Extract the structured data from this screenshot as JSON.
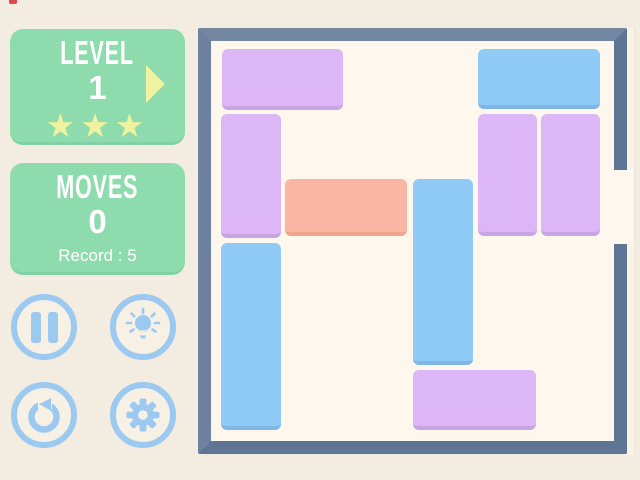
{
  "app": {
    "background_color": "#F3ECE1",
    "decor": {
      "red_notch_color": "#E0484C"
    }
  },
  "hud": {
    "level_panel": {
      "title": "LEVEL",
      "value": "1",
      "stars": 3,
      "bg_color": "#8EDCAD",
      "star_color": "#EFF29E",
      "arrow_color": "#EFF29E"
    },
    "moves_panel": {
      "title": "MOVES",
      "value": "0",
      "record_label": "Record : 5",
      "bg_color": "#8EDCAD"
    },
    "buttons": [
      {
        "id": "pause",
        "icon": "pause-icon"
      },
      {
        "id": "hint",
        "icon": "lightbulb-icon"
      },
      {
        "id": "restart",
        "icon": "restart-icon"
      },
      {
        "id": "settings",
        "icon": "gear-icon"
      }
    ],
    "button_accent_color": "#9CC9F0"
  },
  "board": {
    "border_color": "#64799A",
    "floor_color": "#FDF7ED",
    "grid": {
      "cols": 6,
      "rows": 6
    },
    "exit": {
      "side": "right",
      "row": 2
    },
    "block_colors": {
      "purple": {
        "fill": "#DCB6F6",
        "edge": "#C7A4E2"
      },
      "blue": {
        "fill": "#90CAF7",
        "edge": "#7DB6E7"
      },
      "orange": {
        "fill": "#F9B7A3",
        "edge": "#EFA58D"
      }
    },
    "blocks": [
      {
        "id": 1,
        "color": "purple",
        "key": false,
        "col": 0,
        "row": 0,
        "span_w": 2,
        "span_h": 1,
        "x": 222,
        "y": 49,
        "w": 121,
        "h": 61
      },
      {
        "id": 2,
        "color": "blue",
        "key": false,
        "col": 4,
        "row": 0,
        "span_w": 2,
        "span_h": 1,
        "x": 478,
        "y": 49,
        "w": 122,
        "h": 60
      },
      {
        "id": 3,
        "color": "purple",
        "key": false,
        "col": 0,
        "row": 1,
        "span_w": 1,
        "span_h": 2,
        "x": 221,
        "y": 114,
        "w": 60,
        "h": 124
      },
      {
        "id": 4,
        "color": "purple",
        "key": false,
        "col": 4,
        "row": 1,
        "span_w": 1,
        "span_h": 2,
        "x": 478,
        "y": 114,
        "w": 59,
        "h": 122
      },
      {
        "id": 5,
        "color": "purple",
        "key": false,
        "col": 5,
        "row": 1,
        "span_w": 1,
        "span_h": 2,
        "x": 541,
        "y": 114,
        "w": 59,
        "h": 122
      },
      {
        "id": 6,
        "color": "orange",
        "key": true,
        "col": 1,
        "row": 2,
        "span_w": 2,
        "span_h": 1,
        "x": 285,
        "y": 179,
        "w": 122,
        "h": 57
      },
      {
        "id": 7,
        "color": "blue",
        "key": false,
        "col": 3,
        "row": 2,
        "span_w": 1,
        "span_h": 3,
        "x": 413,
        "y": 179,
        "w": 60,
        "h": 186
      },
      {
        "id": 8,
        "color": "blue",
        "key": false,
        "col": 0,
        "row": 3,
        "span_w": 1,
        "span_h": 3,
        "x": 221,
        "y": 243,
        "w": 60,
        "h": 187
      },
      {
        "id": 9,
        "color": "purple",
        "key": false,
        "col": 3,
        "row": 5,
        "span_w": 2,
        "span_h": 1,
        "x": 413,
        "y": 370,
        "w": 123,
        "h": 60
      }
    ]
  }
}
